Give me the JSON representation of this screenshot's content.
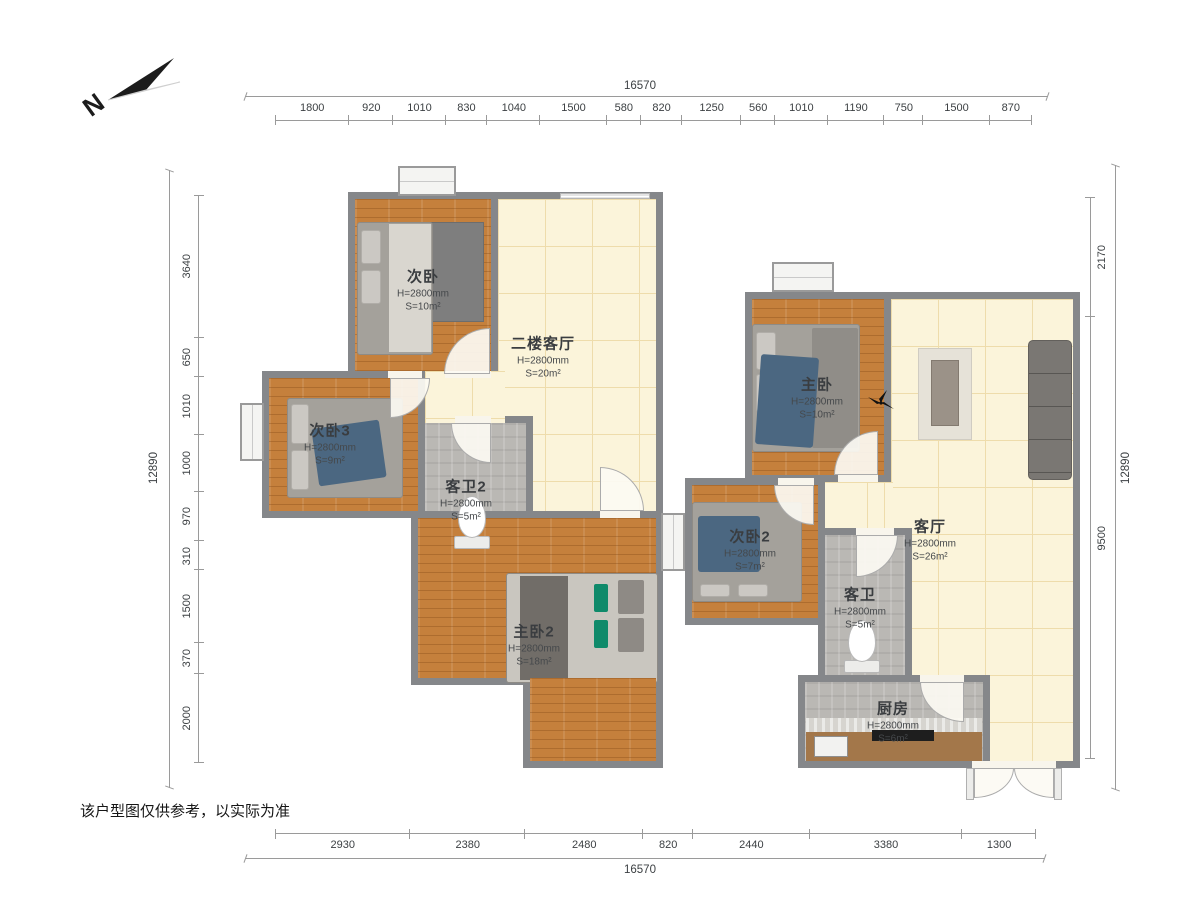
{
  "compass": {
    "label": "N"
  },
  "disclaimer": "该户型图仅供参考，以实际为准",
  "dimensions": {
    "top": {
      "total": "16570",
      "segments": [
        1800,
        920,
        1010,
        830,
        1040,
        1500,
        580,
        820,
        1250,
        560,
        1010,
        1190,
        750,
        1500,
        870
      ]
    },
    "bottom": {
      "total": "16570",
      "segments": [
        2930,
        2380,
        2480,
        820,
        2440,
        3380,
        1300
      ]
    },
    "left": {
      "total": "12890",
      "segments": [
        3640,
        650,
        1010,
        1000,
        970,
        310,
        1500,
        370,
        2000
      ]
    },
    "right": {
      "total": "12890",
      "segments": [
        2170,
        9500
      ]
    }
  },
  "rooms": [
    {
      "name": "次卧",
      "height": "H=2800mm",
      "area": "S=10m²"
    },
    {
      "name": "二楼客厅",
      "height": "H=2800mm",
      "area": "S=20m²"
    },
    {
      "name": "次卧3",
      "height": "H=2800mm",
      "area": "S=9m²"
    },
    {
      "name": "客卫2",
      "height": "H=2800mm",
      "area": "S=5m²"
    },
    {
      "name": "主卧2",
      "height": "H=2800mm",
      "area": "S=18m²"
    },
    {
      "name": "主卧",
      "height": "H=2800mm",
      "area": "S=10m²"
    },
    {
      "name": "客厅",
      "height": "H=2800mm",
      "area": "S=26m²"
    },
    {
      "name": "次卧2",
      "height": "H=2800mm",
      "area": "S=7m²"
    },
    {
      "name": "客卫",
      "height": "H=2800mm",
      "area": "S=5m²"
    },
    {
      "name": "厨房",
      "height": "H=2800mm",
      "area": "S=6m²"
    }
  ]
}
